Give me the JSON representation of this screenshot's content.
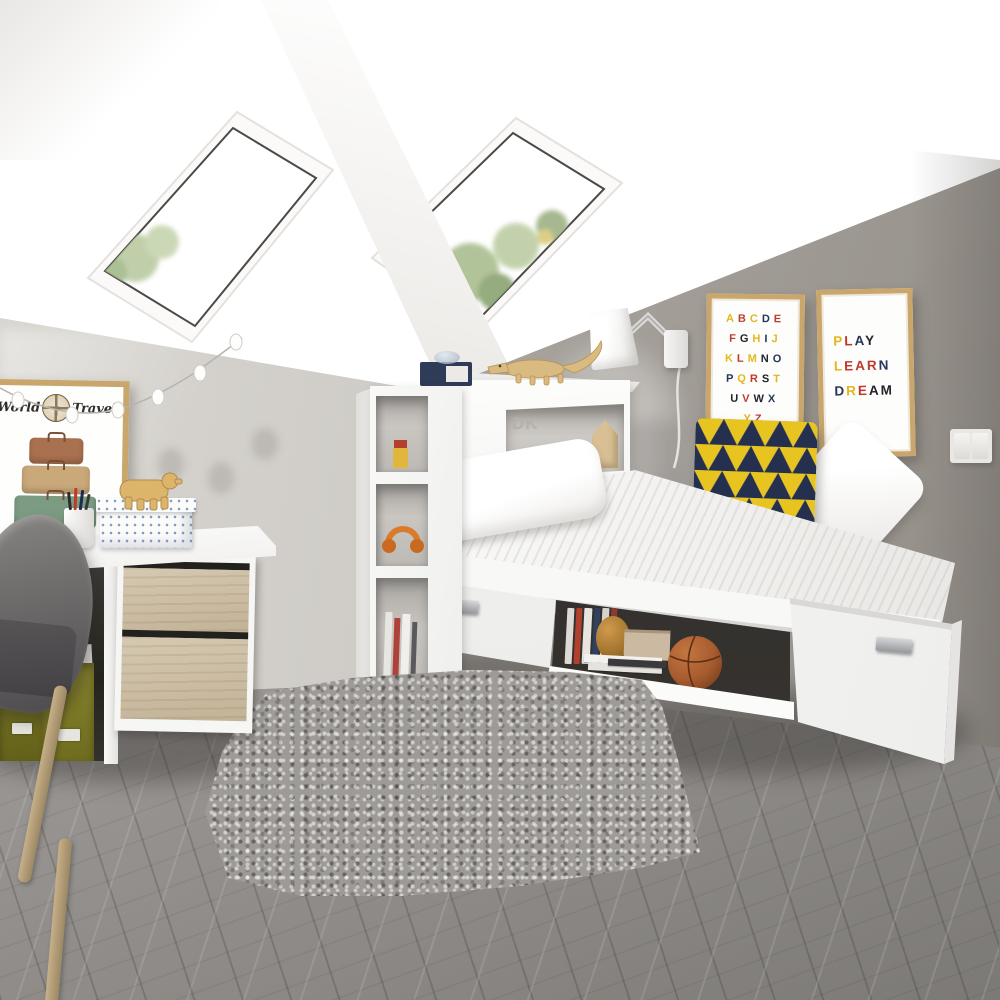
{
  "scene": {
    "name": "attic-kids-bedroom-photo",
    "description": "White attic bedroom with skylights, storage bed, headboard shelving, desk with oak drawers, grey shag rug"
  },
  "palette": {
    "ceiling_white": "#fbfaf8",
    "slope_grey": "#dcd8d3",
    "back_wall_grey": "#a8a39d",
    "left_wall_grey": "#d2cfca",
    "floor_grey": "#a5a19d",
    "rug_grey": "#9d9a97",
    "furniture_white": "#f7f7f6",
    "oak": "#cdbfa6",
    "frame_gold": "#c9a66b",
    "accent_yellow": "#e3b71e",
    "accent_red": "#c0392b",
    "accent_navy": "#27355a",
    "accent_black": "#23232b",
    "olive_box": "#6e6b1e",
    "headphones_orange": "#d97b2a",
    "toy_wood": "#d9ba80",
    "basketball": "#a85c30",
    "navy_box": "#2e3c58",
    "foliage_green": "#a9bd8e"
  },
  "posters": {
    "alphabet": {
      "rows": [
        [
          {
            "ch": "A",
            "c": "#e3b71e"
          },
          {
            "ch": "B",
            "c": "#c0392b"
          },
          {
            "ch": "C",
            "c": "#e3b71e"
          },
          {
            "ch": "D",
            "c": "#27355a"
          },
          {
            "ch": "E",
            "c": "#c0392b"
          }
        ],
        [
          {
            "ch": "F",
            "c": "#c0392b"
          },
          {
            "ch": "G",
            "c": "#23232b"
          },
          {
            "ch": "H",
            "c": "#e3b71e"
          },
          {
            "ch": "I",
            "c": "#27355a"
          },
          {
            "ch": "J",
            "c": "#e3b71e"
          }
        ],
        [
          {
            "ch": "K",
            "c": "#e3b71e"
          },
          {
            "ch": "L",
            "c": "#c0392b"
          },
          {
            "ch": "M",
            "c": "#e3b71e"
          },
          {
            "ch": "N",
            "c": "#23232b"
          },
          {
            "ch": "O",
            "c": "#27355a"
          }
        ],
        [
          {
            "ch": "P",
            "c": "#27355a"
          },
          {
            "ch": "Q",
            "c": "#e3b71e"
          },
          {
            "ch": "R",
            "c": "#c0392b"
          },
          {
            "ch": "S",
            "c": "#23232b"
          },
          {
            "ch": "T",
            "c": "#e3b71e"
          }
        ],
        [
          {
            "ch": "U",
            "c": "#23232b"
          },
          {
            "ch": "V",
            "c": "#c0392b"
          },
          {
            "ch": "W",
            "c": "#23232b"
          },
          {
            "ch": "X",
            "c": "#27355a"
          }
        ],
        [
          {
            "ch": "Y",
            "c": "#e3b71e"
          },
          {
            "ch": "Z",
            "c": "#c0392b"
          }
        ]
      ]
    },
    "play_learn_dream": {
      "lines": [
        [
          {
            "ch": "P",
            "c": "#e3b71e"
          },
          {
            "ch": "L",
            "c": "#c0392b"
          },
          {
            "ch": "A",
            "c": "#27355a"
          },
          {
            "ch": "Y",
            "c": "#23232b"
          }
        ],
        [
          {
            "ch": "L",
            "c": "#e3b71e"
          },
          {
            "ch": "E",
            "c": "#c0392b"
          },
          {
            "ch": "A",
            "c": "#c0392b"
          },
          {
            "ch": "R",
            "c": "#c0392b"
          },
          {
            "ch": "N",
            "c": "#27355a"
          }
        ],
        [
          {
            "ch": "D",
            "c": "#27355a"
          },
          {
            "ch": "R",
            "c": "#e3b71e"
          },
          {
            "ch": "E",
            "c": "#c0392b"
          },
          {
            "ch": "A",
            "c": "#23232b"
          },
          {
            "ch": "M",
            "c": "#23232b"
          }
        ]
      ]
    },
    "world_travel": {
      "left_word": "World",
      "right_word": "Travel"
    }
  },
  "headboard_niche": {
    "logo_text": "DK"
  },
  "objects": [
    "skylight-window",
    "roof-beam",
    "string-light-garland",
    "wall-lamp",
    "light-switch",
    "world-travel-poster",
    "suitcase-stack-art",
    "globe-art",
    "pen-cup",
    "patterned-storage-box",
    "wooden-bear-figurine",
    "desk-oak-drawers",
    "olive-storage-boxes",
    "grey-chair",
    "headboard-bookcase",
    "orange-headphones",
    "navy-storage-box",
    "glass-bowl",
    "wooden-crocodile-toy",
    "wooden-house-ornament",
    "white-pillow",
    "triangle-pattern-cushion",
    "white-cushion",
    "striped-duvet",
    "underbed-drawer",
    "underbed-cubby-books",
    "basketball",
    "grey-shag-rug",
    "herringbone-floor"
  ]
}
